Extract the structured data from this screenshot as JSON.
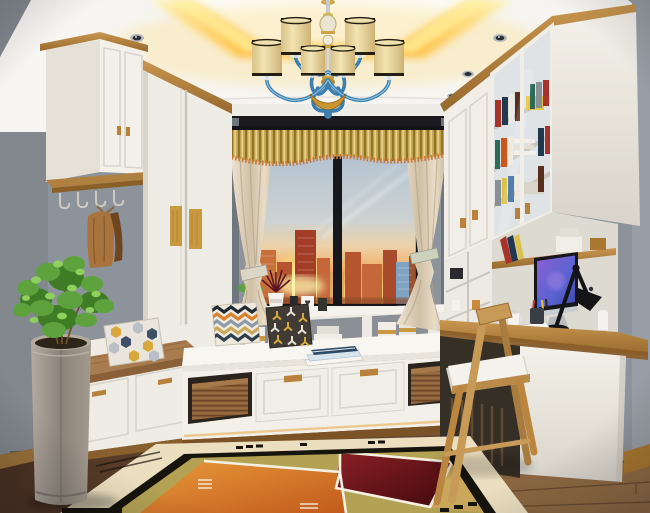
{
  "meta": {
    "type": "interior-3d-render",
    "width": 650,
    "height": 513
  },
  "scene": {
    "room": "small study / tatami window-seat room",
    "view": "city skyline at sunset through a two-pane window",
    "style": "modern white cabinetry with oak accents",
    "lighting": [
      "yellow LED cove in tray ceiling",
      "recessed downlights",
      "toe-kick glow"
    ]
  },
  "palette": {
    "wall_left": "#83888f",
    "wall_right": "#989ea5",
    "wall_alcove": "#8d939b",
    "ceiling": "#f6f5f2",
    "cove_glow": "#ffc84a",
    "cabinet_white": "#f1eee7",
    "wood": "#b9833c",
    "wood_dark": "#8a5c28",
    "pelmet": "#1a1a1e",
    "valance": "#c2a24e",
    "curtain": "#e8dcc6",
    "window_frame": "#17181b",
    "sky": "#b3c2d1",
    "sunset": "#f2a85c",
    "sun": "#fff3a8",
    "building_orange": "#c96f3a",
    "building_red": "#a33d28",
    "building_blue": "#7fa3c2",
    "seat_white": "#f3f0e9",
    "cushion_brown": "#a87c4f",
    "basket": "#8a5f38",
    "pillow_gold": "#d9a83c",
    "pillow_navy": "#3e5068",
    "floor_dark": "#4e3523",
    "floor_light": "#8a6644",
    "rug_cream": "#ecdfc0",
    "rug_black": "#17130d",
    "rug_orange": "#d9822f",
    "rug_maroon": "#6e151b",
    "rug_olive": "#b3a254",
    "plant_green": "#5da23d",
    "planter_gray": "#9a928a",
    "chair_wood": "#c79a58",
    "lamp_black": "#141417",
    "screen_purple": "#7a57c9"
  },
  "objects": [
    {
      "id": "chandelier",
      "label": "8-shade chandelier, cream drum shades with black trim, blue glass arms"
    },
    {
      "id": "tray-ceiling",
      "label": "white tray ceiling with yellow cove lighting and downlights"
    },
    {
      "id": "window",
      "label": "black two-pane window, sunset skyline, contrails"
    },
    {
      "id": "valance",
      "label": "gold pleated valance with fringe over cream tied-back curtains"
    },
    {
      "id": "left-upper-cabinet",
      "label": "white wall cabinet with oak crown and hook rail with hanging coat"
    },
    {
      "id": "wardrobe",
      "label": "white sliding-door wardrobe with oak inlay handles"
    },
    {
      "id": "bench",
      "label": "storage bench with brown cushion and hexagon pillow"
    },
    {
      "id": "window-seat",
      "label": "white platform seat with two drawers and wicker baskets"
    },
    {
      "id": "pillows",
      "label": "chevron pillow and gold geometric pillow"
    },
    {
      "id": "bookcase",
      "label": "glass-door bookcase with colorful books"
    },
    {
      "id": "desk",
      "label": "oak desk with monitor, black task lamp, mug, pens, papers, speaker"
    },
    {
      "id": "chair",
      "label": "oak chair with white cushion"
    },
    {
      "id": "rug",
      "label": "geometric rug: cream border, black frame, orange/maroon/olive field"
    },
    {
      "id": "plant",
      "label": "green potted plant in tall gray cylinder planter"
    },
    {
      "id": "floor",
      "label": "dark oak plank floor"
    }
  ]
}
